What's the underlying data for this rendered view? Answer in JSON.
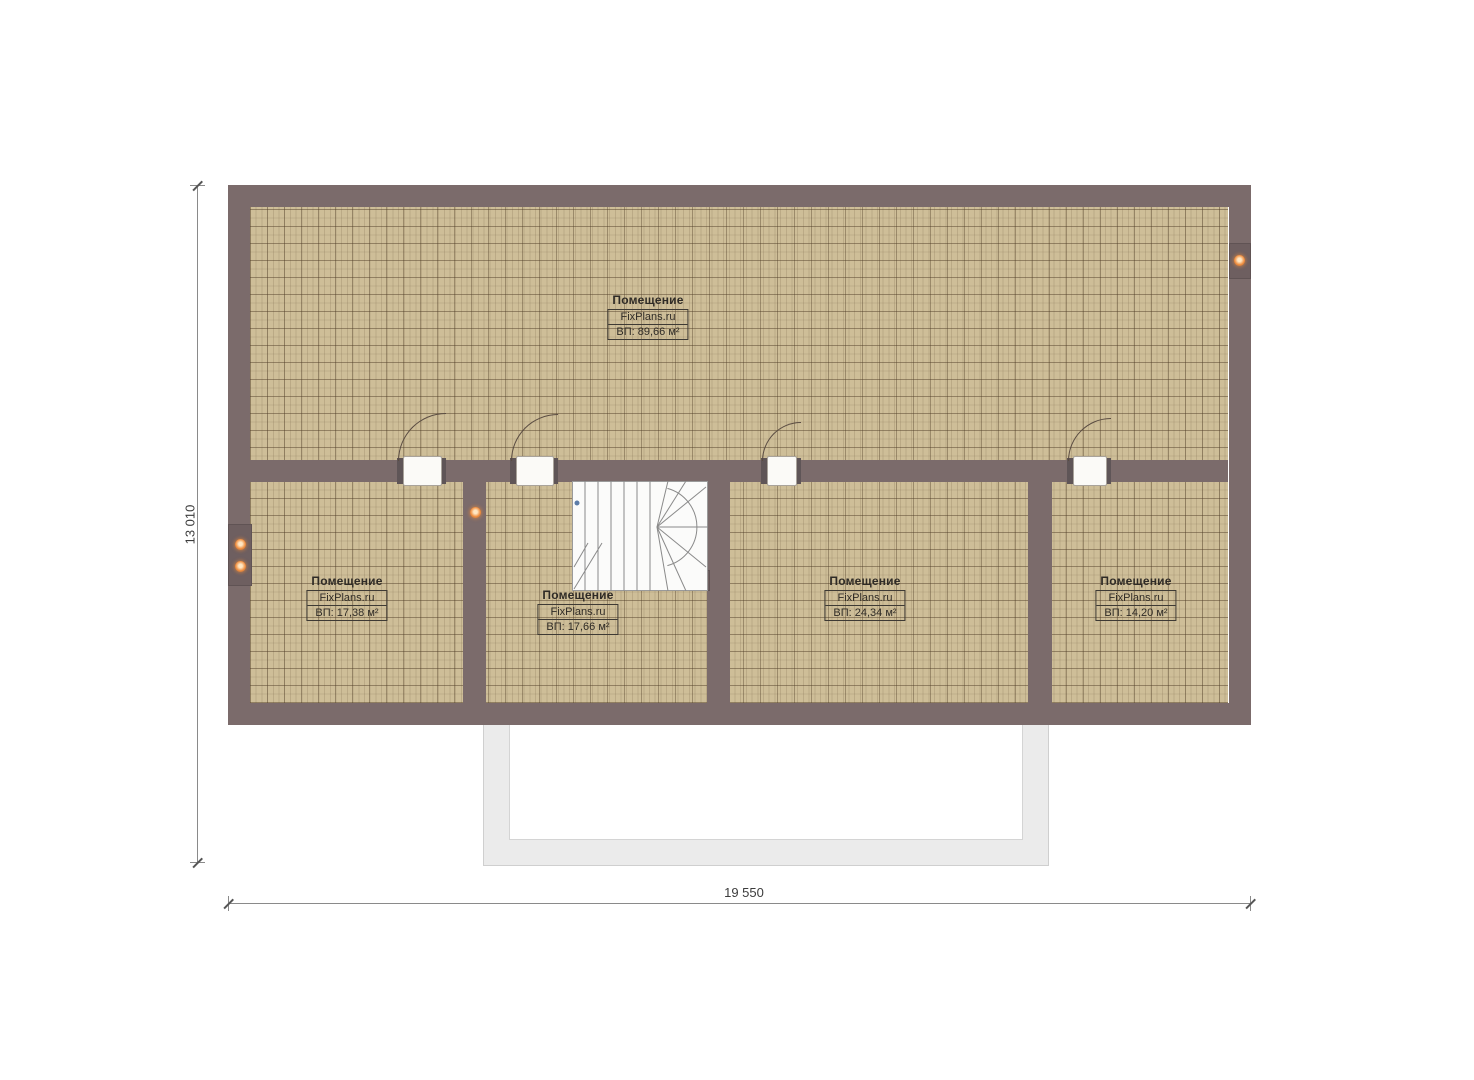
{
  "plan": {
    "rooms": [
      {
        "name": "Помещение",
        "brand": "FixPlans.ru",
        "area": "ВП: 89,66 м²"
      },
      {
        "name": "Помещение",
        "brand": "FixPlans.ru",
        "area": "ВП: 17,38 м²"
      },
      {
        "name": "Помещение",
        "brand": "FixPlans.ru",
        "area": "ВП: 17,66 м²"
      },
      {
        "name": "Помещение",
        "brand": "FixPlans.ru",
        "area": "ВП: 24,34 м²"
      },
      {
        "name": "Помещение",
        "brand": "FixPlans.ru",
        "area": "ВП: 14,20 м²"
      }
    ],
    "dimensions": {
      "height_label": "13 010",
      "width_label": "19 550"
    },
    "colors": {
      "wall": "#7b6b6b",
      "floor": "#cebe98",
      "grid_line": "#4e3c26",
      "accent_dot": "#ee8a3a",
      "terrace": "#ebebeb",
      "door_arc": "#5a4c42"
    }
  }
}
